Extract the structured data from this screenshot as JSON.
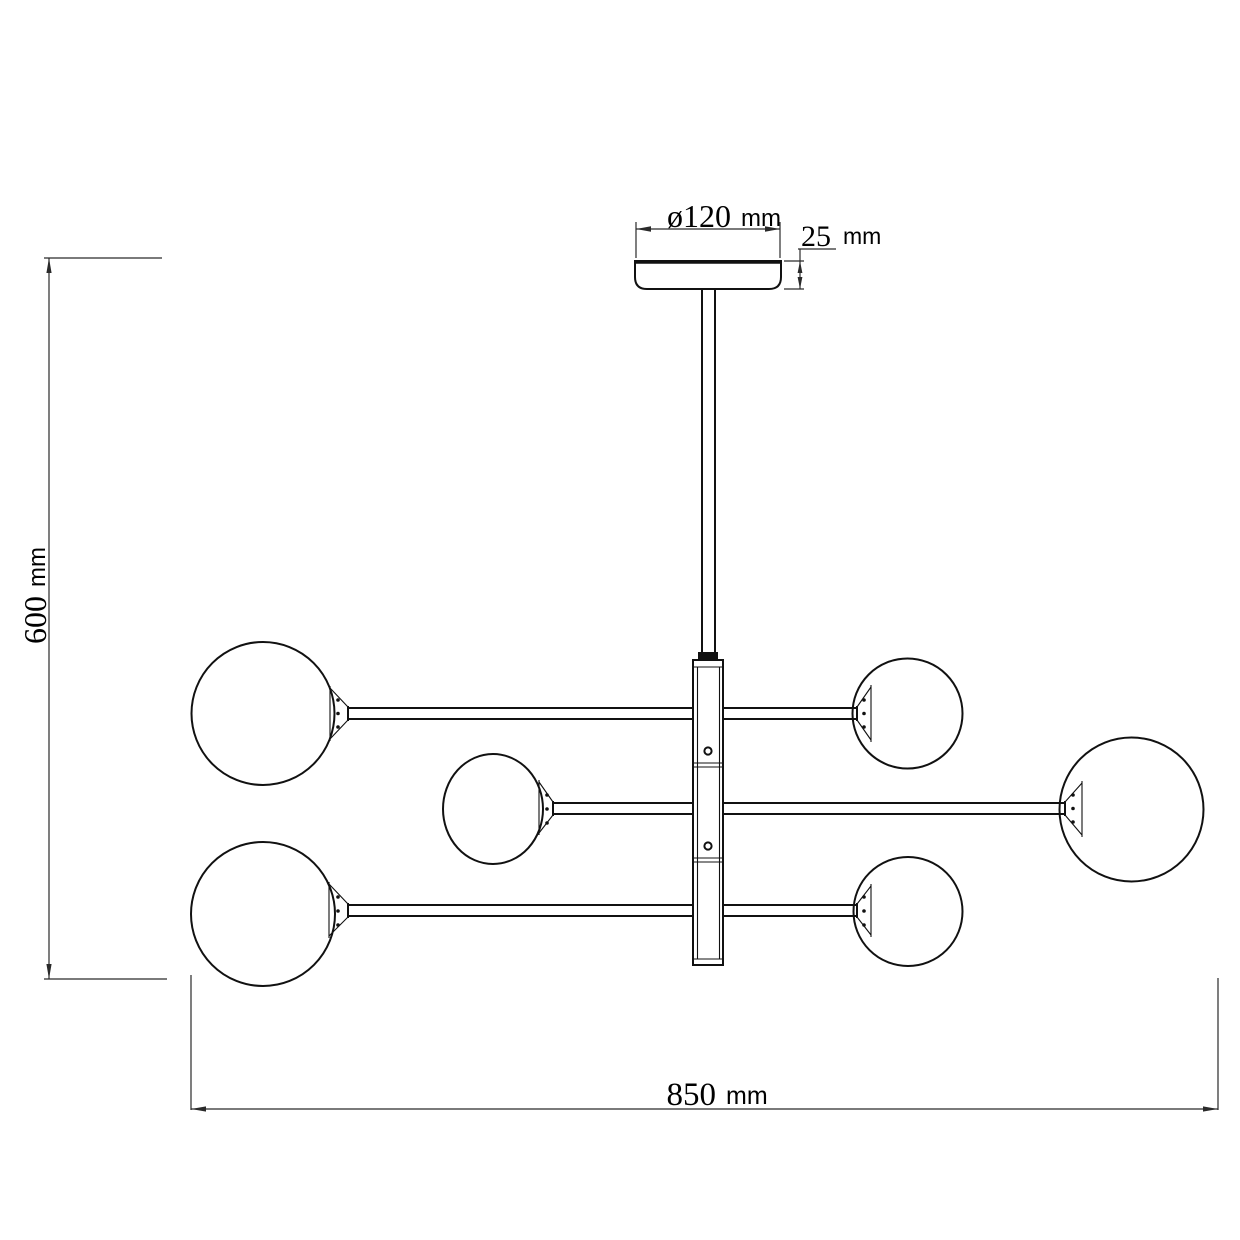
{
  "drawing": {
    "kind": "technical-line-drawing",
    "fixture": {
      "globe_count": 6,
      "arm_row_count": 3,
      "column_screw_count": 2
    },
    "labels": {
      "canopy_diameter": {
        "value": "ø120",
        "unit": "mm"
      },
      "canopy_height": {
        "value": "25",
        "unit": "mm"
      },
      "overall_height": {
        "value": "600",
        "unit": "mm"
      },
      "overall_width": {
        "value": "850",
        "unit": "mm"
      }
    },
    "colors": {
      "line": "#111111",
      "dimension": "#2a2a2a",
      "background": "#ffffff"
    }
  }
}
